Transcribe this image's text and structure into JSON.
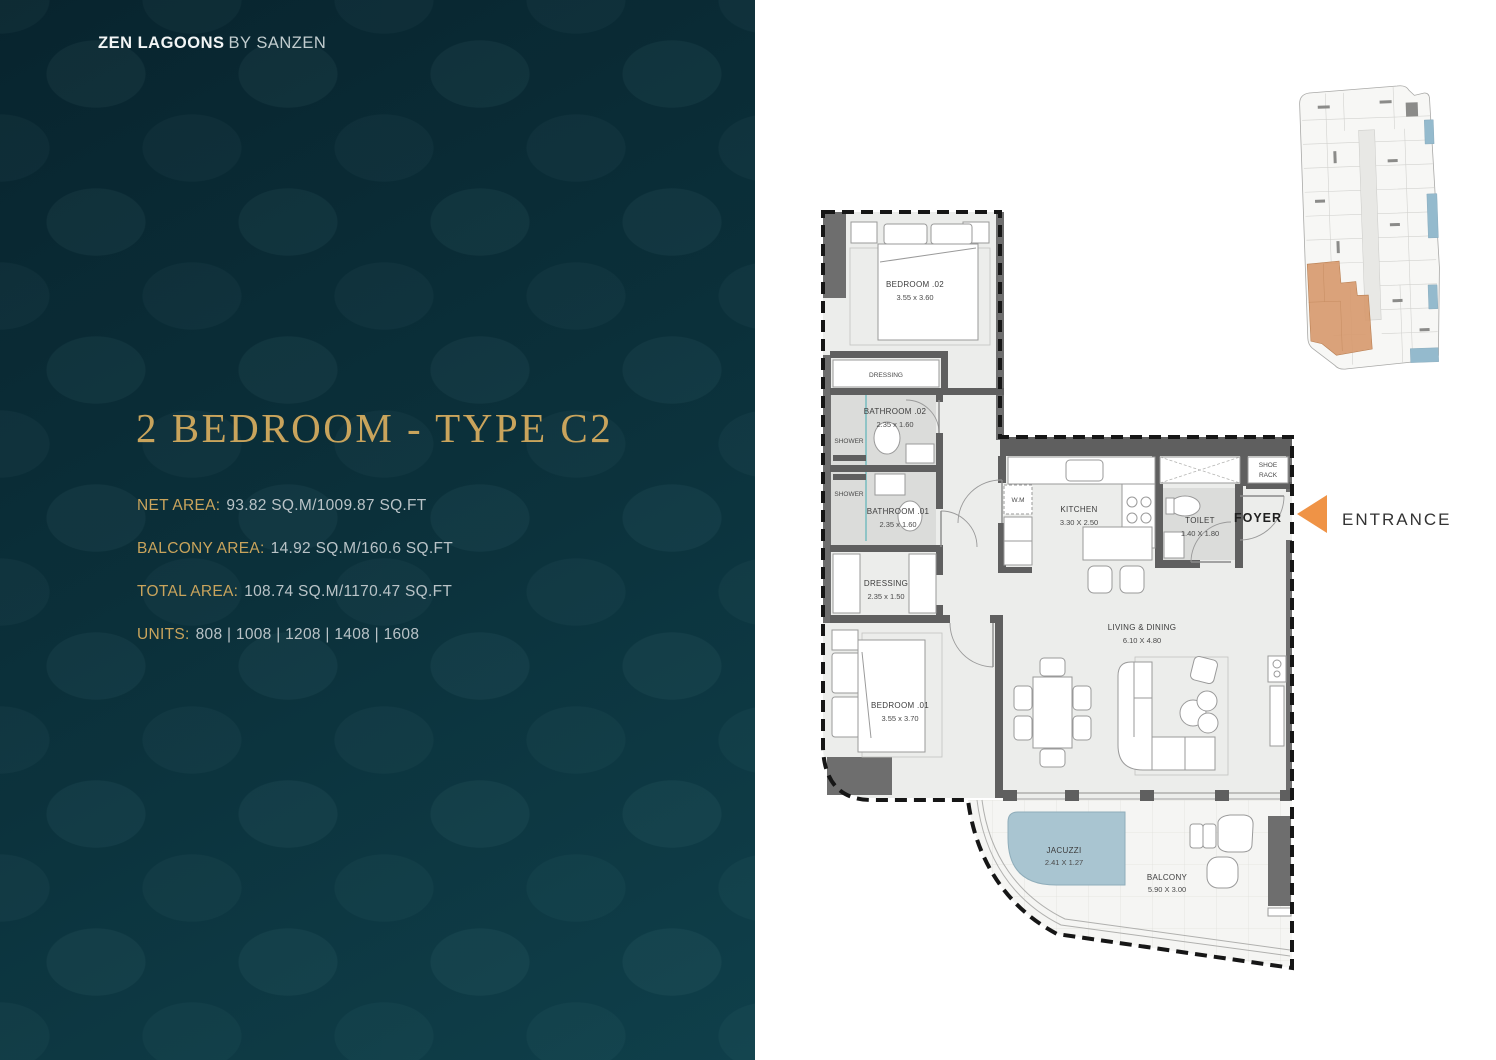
{
  "brand": {
    "name": "ZEN LAGOONS",
    "suffix": "BY SANZEN"
  },
  "unit": {
    "title": "2 BEDROOM - TYPE C2",
    "details": [
      {
        "label": "NET AREA:",
        "value": "93.82 SQ.M/1009.87 SQ.FT"
      },
      {
        "label": "BALCONY AREA:",
        "value": "14.92 SQ.M/160.6 SQ.FT"
      },
      {
        "label": "TOTAL AREA:",
        "value": "108.74 SQ.M/1170.47 SQ.FT"
      },
      {
        "label": "UNITS:",
        "value": "808 | 1008 | 1208 | 1408 | 1608"
      }
    ]
  },
  "floorplan": {
    "rooms": {
      "bedroom_02": {
        "name": "BEDROOM .02",
        "dims": "3.55 x 3.60"
      },
      "dressing_upper": {
        "name": "DRESSING"
      },
      "bathroom_02": {
        "name": "BATHROOM .02",
        "dims": "2.35 x 1.60"
      },
      "shower_upper": {
        "name": "SHOWER"
      },
      "shower_lower": {
        "name": "SHOWER"
      },
      "bathroom_01": {
        "name": "BATHROOM .01",
        "dims": "2.35 x 1.60"
      },
      "dressing_lower": {
        "name": "DRESSING",
        "dims": "2.35 x 1.50"
      },
      "bedroom_01": {
        "name": "BEDROOM .01",
        "dims": "3.55 x 3.70"
      },
      "wm": {
        "name": "W.M"
      },
      "kitchen": {
        "name": "KITCHEN",
        "dims": "3.30 X 2.50"
      },
      "toilet": {
        "name": "TOILET",
        "dims": "1.40 X 1.80"
      },
      "shoe_rack": {
        "line1": "SHOE",
        "line2": "RACK"
      },
      "foyer": {
        "name": "FOYER"
      },
      "living_dining": {
        "name": "LIVING & DINING",
        "dims": "6.10 X 4.80"
      },
      "jacuzzi": {
        "name": "JACUZZI",
        "dims": "2.41 X 1.27"
      },
      "balcony": {
        "name": "BALCONY",
        "dims": "5.90 X 3.00"
      }
    },
    "entrance_label": "ENTRANCE"
  },
  "colors": {
    "accent_gold": "#C9A45C",
    "panel_teal": "#0B303A",
    "entrance_orange": "#EF9346",
    "jacuzzi_blue": "#A9C5D1",
    "keyplan_orange": "#D79A6F",
    "keyplan_blue": "#94BACD"
  }
}
